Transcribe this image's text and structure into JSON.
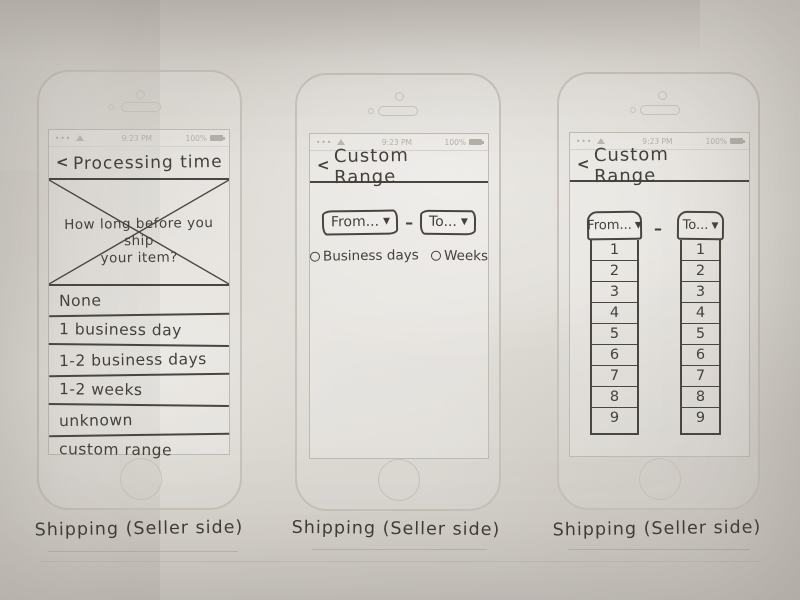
{
  "status_bar": {
    "signal_dots": "•••",
    "time": "9:23 PM",
    "battery": "100%"
  },
  "phone1": {
    "back": "<",
    "title": "Processing time",
    "question_line1": "How long before you ship",
    "question_line2": "your item?",
    "options": [
      "None",
      "1 business day",
      "1-2 business days",
      "1-2 weeks",
      "unknown",
      "custom range"
    ],
    "caption": "Shipping (Seller side)"
  },
  "phone2": {
    "back": "<",
    "title": "Custom Range",
    "from_label": "From...",
    "dash": "–",
    "to_label": "To...",
    "arrow": "▼",
    "radio1": "Business days",
    "radio2": "Weeks",
    "caption": "Shipping (Seller side)"
  },
  "phone3": {
    "back": "<",
    "title": "Custom  Range",
    "from_label": "From...",
    "dash": "–",
    "to_label": "To...",
    "arrow": "▼",
    "from_options": [
      "1",
      "2",
      "3",
      "4",
      "5",
      "6",
      "7",
      "8",
      "9"
    ],
    "to_options": [
      "1",
      "2",
      "3",
      "4",
      "5",
      "6",
      "7",
      "8",
      "9"
    ],
    "caption": "Shipping (Seller side)"
  }
}
